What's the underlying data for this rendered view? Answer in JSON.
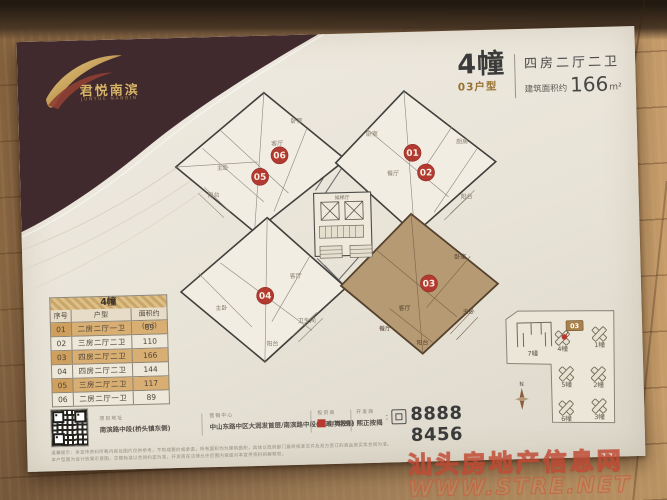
{
  "brand": {
    "name_cn": "君悦南滨",
    "tagline": "JUNYUE NANBIN",
    "gold": "#d4af5e"
  },
  "title": {
    "building": "4幢",
    "unit_type": "03户型",
    "layout": "四房二厅二卫",
    "area_label": "建筑面积约",
    "area_value": "166",
    "area_unit": "m²"
  },
  "floorplan": {
    "units": [
      {
        "id": "01"
      },
      {
        "id": "02"
      },
      {
        "id": "03",
        "highlighted": true
      },
      {
        "id": "04"
      },
      {
        "id": "05"
      },
      {
        "id": "06"
      }
    ],
    "core_label": "候梯厅",
    "rooms": [
      "阳台",
      "卧室",
      "主卧",
      "客厅",
      "餐厅",
      "厨房",
      "卫生间",
      "书房"
    ],
    "highlight_color": "#b69a74",
    "marker_color": "#b23a30"
  },
  "table": {
    "title": "4幢",
    "headers": [
      "序号",
      "户型",
      "面积约(m²)"
    ],
    "rows": [
      {
        "no": "01",
        "layout": "二房二厅一卫",
        "area": "89"
      },
      {
        "no": "02",
        "layout": "三房二厅二卫",
        "area": "110"
      },
      {
        "no": "03",
        "layout": "四房二厅二卫",
        "area": "166"
      },
      {
        "no": "04",
        "layout": "四房二厅二卫",
        "area": "144"
      },
      {
        "no": "05",
        "layout": "三房二厅二卫",
        "area": "117"
      },
      {
        "no": "06",
        "layout": "二房二厅一卫",
        "area": "89"
      }
    ]
  },
  "contact": {
    "address_label": "项目地址",
    "address": "南滨路中段(桥头镇东侧)",
    "center_label": "营销中心",
    "center": "中山东路中区大润发首层/南滨路中段(市政广场旁)",
    "investor_label": "投资商",
    "investor": "中奥控股",
    "developer_label": "开发商",
    "developer": "熙正按揭",
    "separator": ":",
    "phone": "8888 8456"
  },
  "disclaimer": {
    "line1": "温馨提示：本宣传资料所载内容及图片仅供参考，不构成要约或承诺，所有面积均为建筑面积，具体以政府部门最终核准文件及双方签订的商品房买卖合同为准。",
    "line2": "本户型图为设计效果示意图，交楼标准以合同约定为准，开发商在法律允许范围内保留对本宣传资料的解释权。"
  },
  "siteplan": {
    "buildings": [
      "7幢",
      "4幢",
      "1幢",
      "5幢",
      "2幢",
      "6幢",
      "3幢"
    ],
    "unit_tag": "03",
    "compass": "N"
  },
  "watermark": {
    "line1": "汕头房地产信息网",
    "line2": "WWW.STRE.NET"
  },
  "colors": {
    "paper": "#eae5da",
    "corner_blob": "#402a2e",
    "accent_gold": "#c9a25e",
    "highlight_tan": "#b69a74",
    "marker_red": "#b23a30",
    "wood_floor": "#b08a5e"
  }
}
